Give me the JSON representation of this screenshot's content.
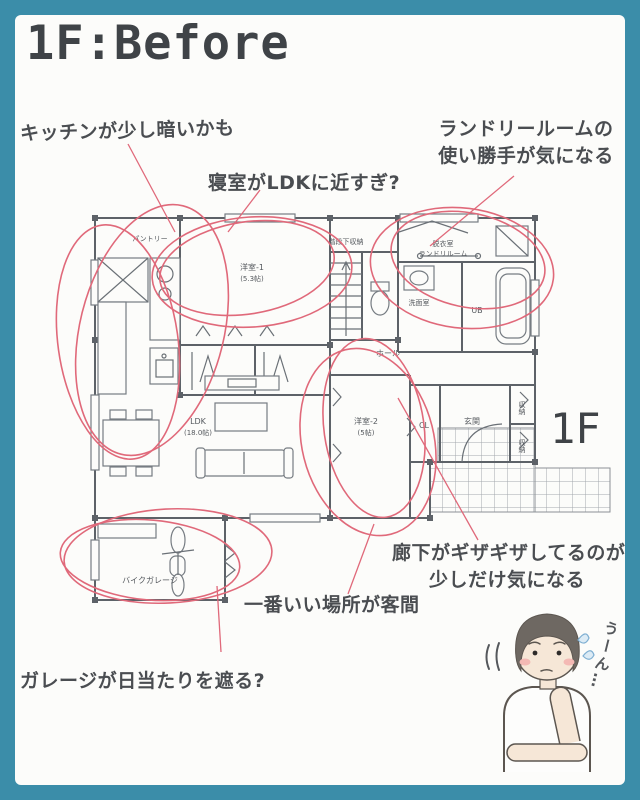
{
  "title": "1F:Before",
  "floor_badge": "1F",
  "notes": {
    "kitchen": "キッチンが少し暗いかも",
    "bedroom": "寝室がLDKに近すぎ?",
    "laundry_1": "ランドリールームの",
    "laundry_2": "使い勝手が気になる",
    "hallway_1": "廊下がギザギザしてるのが",
    "hallway_2": "少しだけ気になる",
    "guest": "一番いい場所が客間",
    "garage": "ガレージが日当たりを遮る?"
  },
  "plan": {
    "pantry": "パントリー",
    "bedroom1_name": "洋室-1",
    "bedroom1_size": "(5.3帖)",
    "under_stair_storage": "階段下収納",
    "laundry_room_1": "脱衣室",
    "laundry_room_2": "ランドリルーム",
    "washroom": "洗面室",
    "unit_bath": "UB",
    "hall": "ホール",
    "bedroom2_name": "洋室-2",
    "bedroom2_size": "(5帖)",
    "closet": "CL",
    "entrance": "玄関",
    "storage_top": "収納",
    "storage_bottom": "収納",
    "ldk_name": "LDK",
    "ldk_size": "(18.0帖)",
    "bike_garage": "バイクガレージ"
  },
  "character": {
    "speech": "うーん…"
  },
  "colors": {
    "frame_teal": "#3b8da9",
    "annotation_red": "#e0697a",
    "ink": "#4a4d51",
    "wall_gray": "#5d6268"
  }
}
